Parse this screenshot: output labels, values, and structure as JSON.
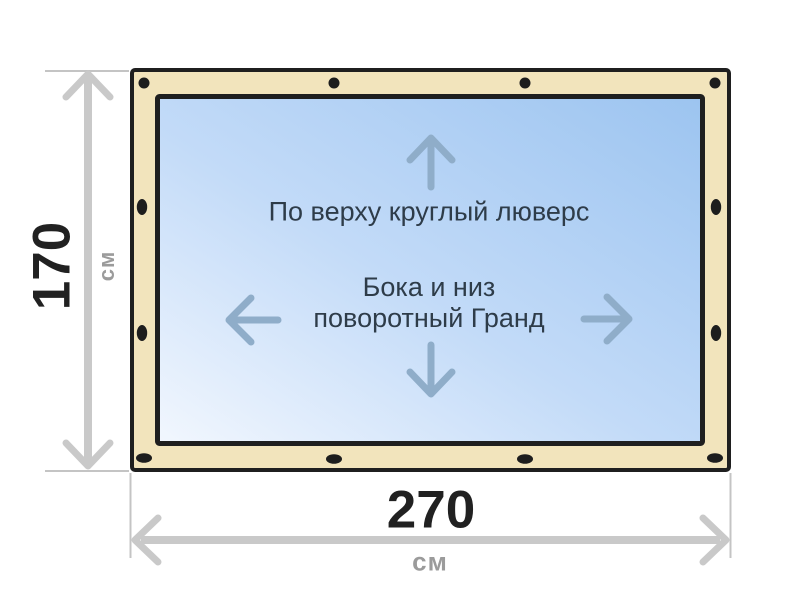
{
  "diagram": {
    "type": "soft-window-size-scheme",
    "curtain": {
      "frame_color": "#f2e4bc",
      "outline_color": "#1f1f1f",
      "grommet_color": "#1d1d1d",
      "window_gradient_start": "#f2f7fe",
      "window_gradient_mid": "#c3dbf8",
      "window_gradient_end": "#9cc4f0",
      "arrow_color": "#8fadc9"
    },
    "notes": {
      "top": "По верху круглый люверс",
      "center_line1": "Бока и низ",
      "center_line2": "поворотный Гранд"
    },
    "icons": [
      "up-arrow-icon",
      "down-arrow-icon",
      "left-arrow-icon",
      "right-arrow-icon"
    ]
  },
  "dimensions": {
    "line_color": "#c9c9c9",
    "value_color": "#212121",
    "unit_color": "#9b9b9b",
    "height": {
      "value": "170",
      "unit": "см"
    },
    "width": {
      "value": "270",
      "unit": "см"
    }
  }
}
